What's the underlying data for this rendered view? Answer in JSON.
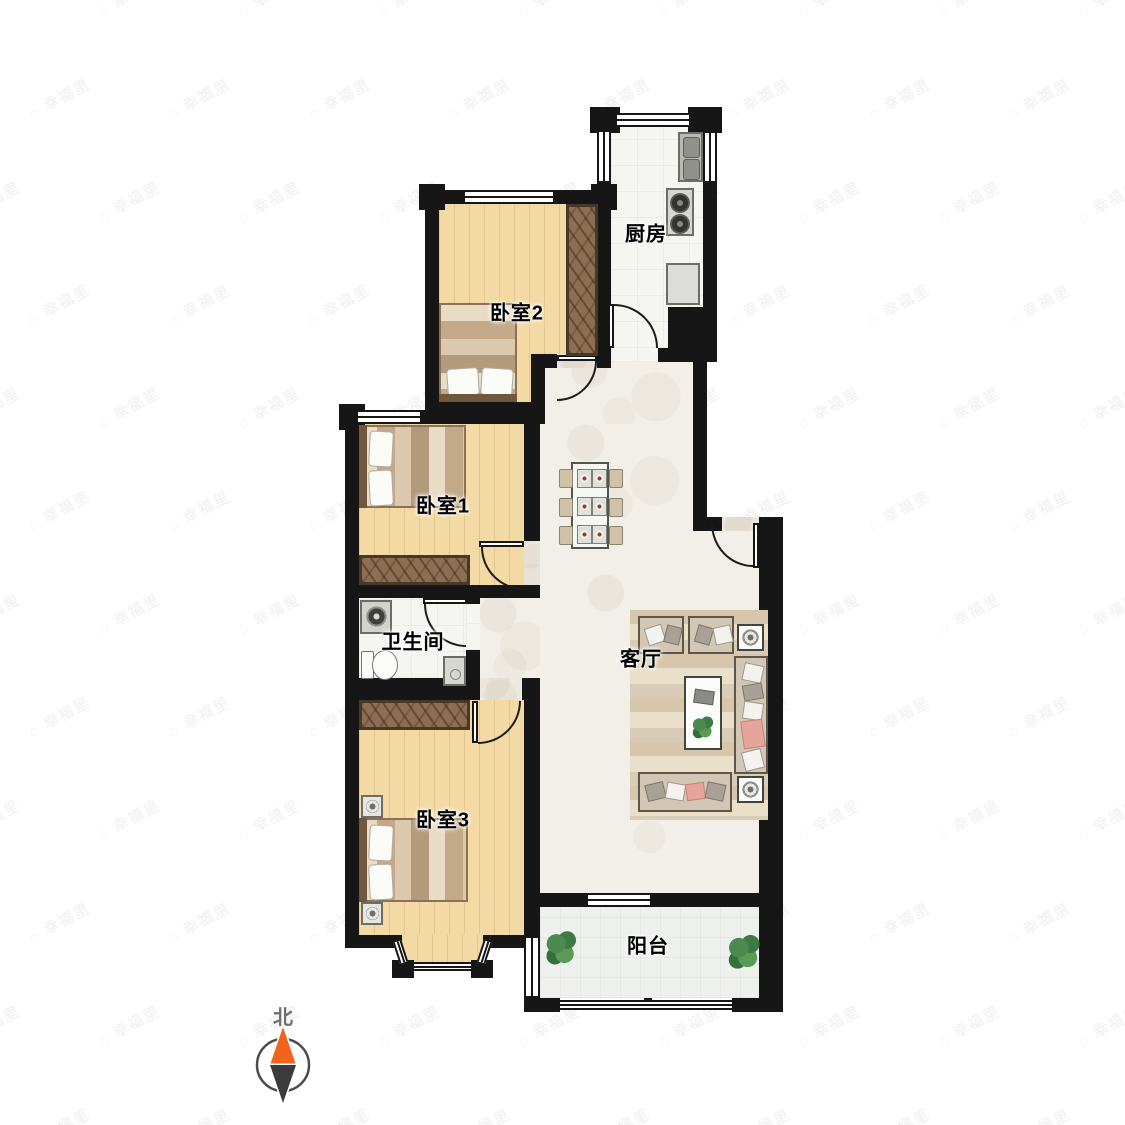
{
  "watermark": {
    "icon": "⌂",
    "text": "幸福里"
  },
  "compass": {
    "label": "北"
  },
  "rooms": {
    "kitchen": {
      "label": "厨房",
      "furniture": [
        "sink",
        "stove",
        "fridge",
        "door"
      ]
    },
    "bedroom2": {
      "label": "卧室2",
      "furniture": [
        "double-bed",
        "wardrobe",
        "window",
        "door"
      ]
    },
    "bedroom1": {
      "label": "卧室1",
      "furniture": [
        "double-bed",
        "wardrobe",
        "window",
        "door"
      ]
    },
    "bathroom": {
      "label": "卫生间",
      "furniture": [
        "washing-machine",
        "toilet",
        "shower",
        "door"
      ]
    },
    "bedroom3": {
      "label": "卧室3",
      "furniture": [
        "double-bed",
        "nightstand",
        "nightstand",
        "wardrobe",
        "bay-window",
        "door"
      ]
    },
    "living": {
      "label": "客厅",
      "furniture": [
        "dining-table",
        "six-chairs",
        "two-armchairs",
        "sofa",
        "sofa",
        "coffee-table",
        "side-table",
        "side-table",
        "rug",
        "entry-door"
      ]
    },
    "balcony": {
      "label": "阳台",
      "furniture": [
        "plant",
        "plant",
        "window"
      ]
    }
  },
  "colors": {
    "wall": "#161616",
    "wood": "#f3d9a3",
    "tile": "#f2efe9",
    "white_floor": "#f5f5f2",
    "wardrobe": "#8d6e53",
    "compass_north": "#f2641e",
    "compass_south": "#3b3b3b",
    "plant": "#4e8c52"
  }
}
